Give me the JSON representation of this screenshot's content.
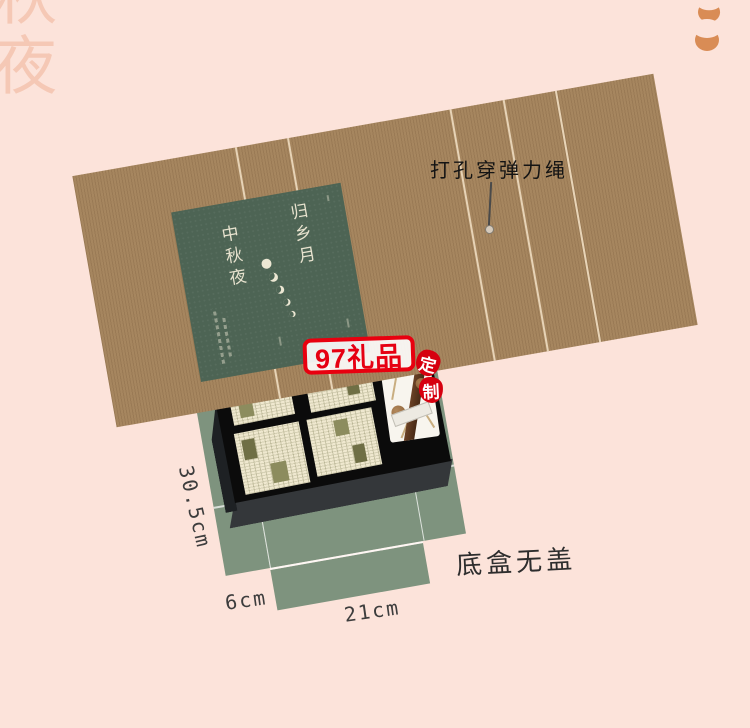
{
  "page": {
    "width": 750,
    "height": 728,
    "background": "#fce3da"
  },
  "decor": {
    "corner_watermark": "秋夜",
    "moon_icon_color": "#d98c55",
    "moon_icon_count": 2
  },
  "lid": {
    "material_color": "#a6865f",
    "crease_count": 5,
    "label": {
      "bg_color": "#4d6454",
      "title_right": "归乡月",
      "title_left": "中秋夜",
      "moon_phase_count": 5
    },
    "callout": {
      "text": "打孔穿弹力绳"
    }
  },
  "bottom_box": {
    "color": "#7e937e",
    "note": "底盒无盖",
    "dimensions": {
      "side": "30.5cm",
      "flap": "6cm",
      "width": "21cm"
    }
  },
  "tray": {
    "color": "#0b0b0b",
    "newspaper_card_count": 4,
    "floral_card_count": 1
  },
  "watermark": {
    "brand": "97礼品",
    "stamp_top": "定",
    "stamp_bottom": "制",
    "color": "#e60012"
  }
}
